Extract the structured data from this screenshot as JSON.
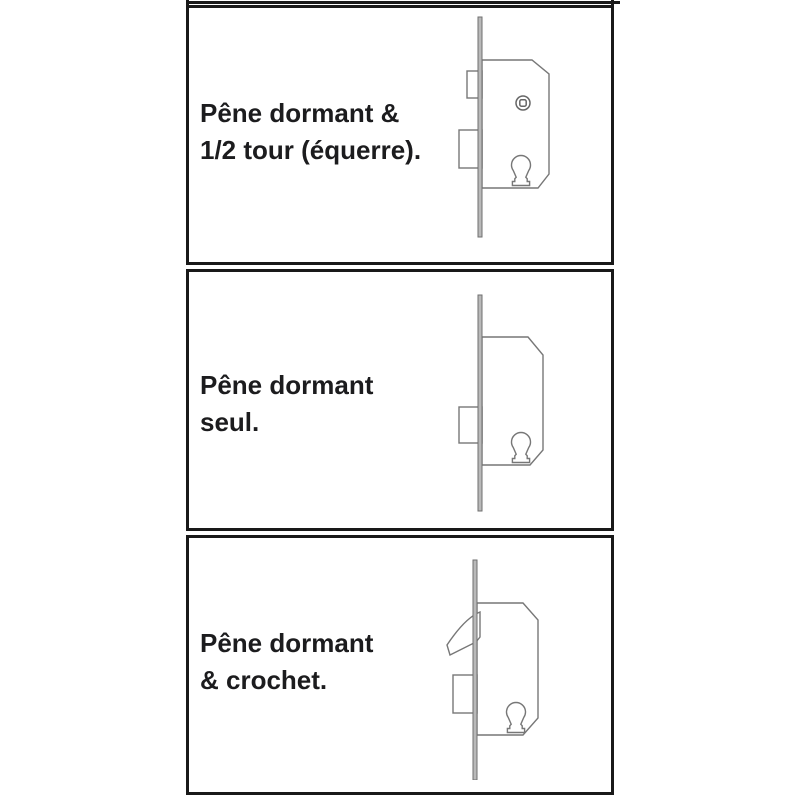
{
  "panels": [
    {
      "id": "deadbolt-and-halfturn",
      "line1": "Pêne dormant &",
      "line2": "1/2 tour (équerre).",
      "diagram": "mortise-lock-side-view-with-deadbolt-and-halfturn-latch"
    },
    {
      "id": "deadbolt-only",
      "line1": "Pêne dormant",
      "line2": "seul.",
      "diagram": "mortise-lock-side-view-with-deadbolt-only"
    },
    {
      "id": "deadbolt-and-hook",
      "line1": "Pêne dormant",
      "line2": "& crochet.",
      "diagram": "mortise-lock-side-view-with-deadbolt-and-hook-bolt"
    }
  ],
  "colors": {
    "background": "#ffffff",
    "panel_border": "#191919",
    "drawing_line": "#777777",
    "faceplate_fill": "#b9b9b9",
    "text": "#1c1c1e"
  }
}
